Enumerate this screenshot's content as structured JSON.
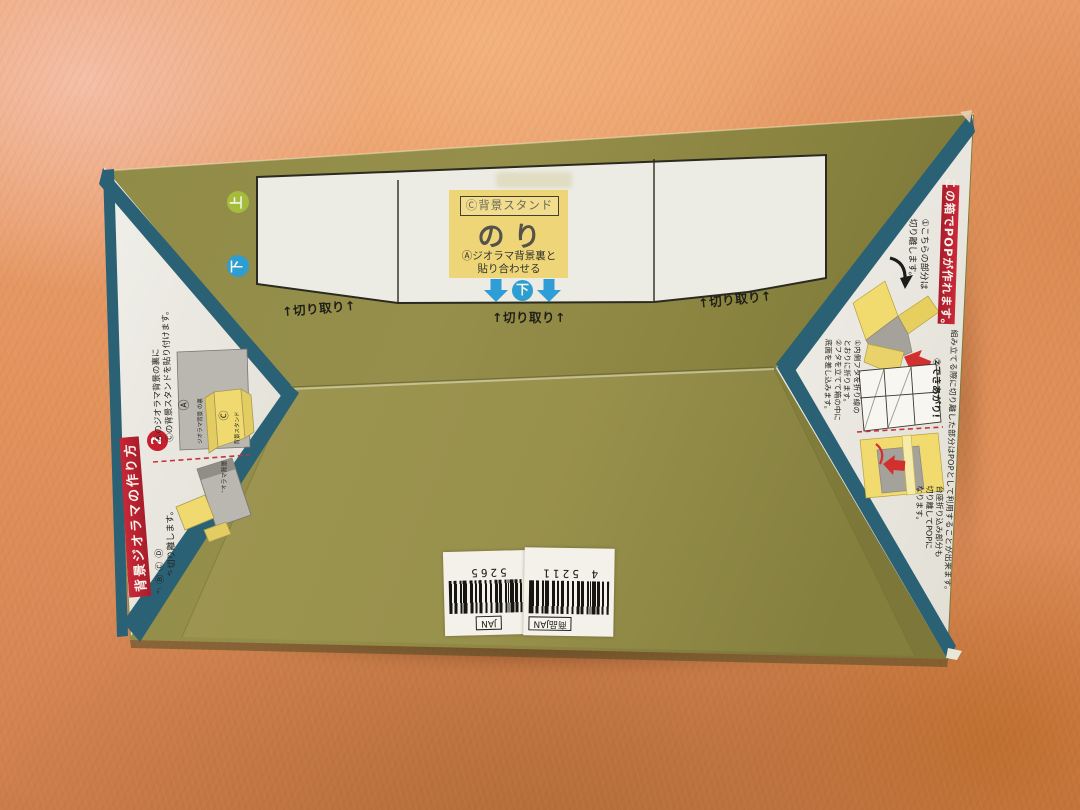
{
  "panel": {
    "stand_label": "Ⓒ背景スタンド",
    "glue_label": "のり",
    "glue_note_line1": "Ⓐジオラマ背景裏と",
    "glue_note_line2": "貼り合わせる",
    "down_badge": "下",
    "cut_label": "↑切り取り↑"
  },
  "markers": {
    "up": "上",
    "down": "下"
  },
  "left_flap": {
    "banner": "背景ジオラマの作り方",
    "step2_number": "2",
    "step2_line1": "Ⓐのジオラマ背景の裏に",
    "step2_line2": "Ⓒの背景スタンドを貼り付けます。",
    "diagram_label_a": "Ⓐ",
    "diagram_caption_a": "ジオラマ背景 の裏",
    "diagram_label_c": "Ⓒ",
    "diagram_caption_c": "背景スタンド",
    "step1_line1": "①ⒷⒸⒹ",
    "step1_line2": "ーツを切り離します。",
    "side_caption": "ジオラマ背景"
  },
  "right_flap": {
    "banner": "この箱でPOPが作れます。",
    "note": "組み立てる際に切り離した部分はPOPとして利用することが出来ます。",
    "step1_line1": "①こちらの部分は",
    "step1_line2": "切り離します。",
    "done_label": "②できあがり!",
    "fold_line1": "①内側フタを折り線の",
    "fold_line2": "とおりに折ります。",
    "fold_line3": "②フタを立てて箱の中に",
    "fold_line4": "底面を差し込みます。",
    "pedestal_line1": "台座折り込み部分も",
    "pedestal_line2": "切り離してPOPに",
    "pedestal_line3": "なります。"
  },
  "barcode": {
    "right_label": "商品JAN",
    "right_digits": "4 5211",
    "left_label": "JAN",
    "left_digits": "5265"
  },
  "colors": {
    "box_olive": "#8f8a45",
    "teal_edge": "#2b6175",
    "banner_red": "#c32536",
    "glue_yellow": "#eed678",
    "arrow_blue": "#2f9ed6",
    "up_green": "#a5bb3c",
    "blanket_orange": "#e2925c"
  }
}
